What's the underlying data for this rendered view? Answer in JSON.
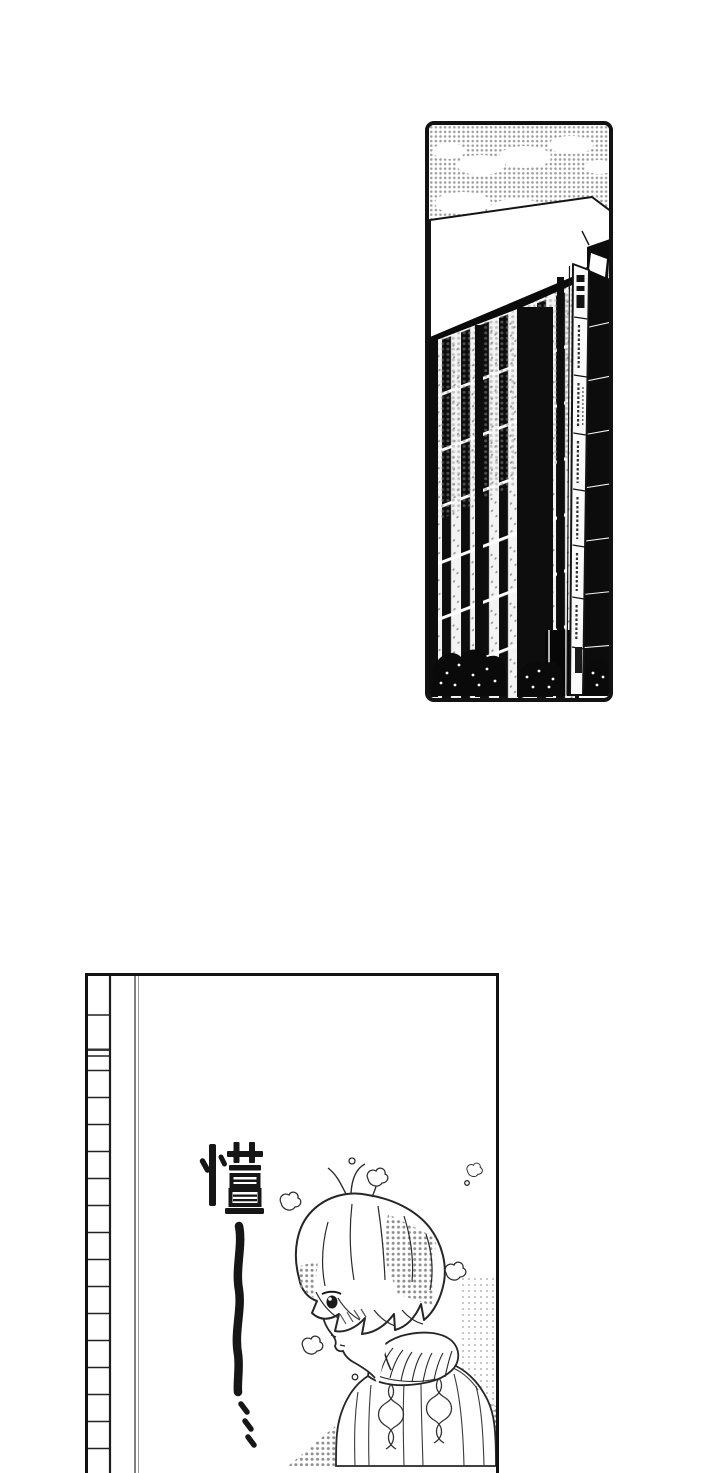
{
  "page": {
    "background_color": "#ffffff",
    "ink_color": "#141414",
    "halftone_color": "#9c9c9c"
  },
  "building_panel": {
    "name": "building-exterior-illustration",
    "sign_name": "vertical-tenant-sign"
  },
  "character_panel": {
    "name": "character-winter-scene-illustration",
    "sfx": {
      "char": "懂",
      "prolongation": "——",
      "trailing_dots": "⋯"
    }
  }
}
